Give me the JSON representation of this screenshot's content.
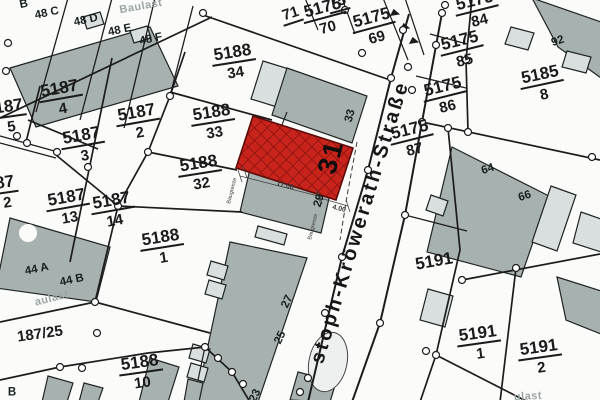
{
  "street": {
    "name": "stoph-Kröwerath-Straße"
  },
  "parcels": {
    "p5188_34": {
      "num": "5188",
      "den": "34"
    },
    "p5188_33": {
      "num": "5188",
      "den": "33"
    },
    "p5188_32": {
      "num": "5188",
      "den": "32"
    },
    "p5188_1": {
      "num": "5188",
      "den": "1"
    },
    "p5188_10": {
      "num": "5188",
      "den": "10"
    },
    "p5187_4": {
      "num": "5187",
      "den": "4"
    },
    "p5187_3": {
      "num": "5187",
      "den": "3"
    },
    "p5187_2": {
      "num": "5187",
      "den": "2"
    },
    "p5187_13": {
      "num": "5187",
      "den": "13"
    },
    "p5187_14": {
      "num": "5187",
      "den": "14"
    },
    "p187_5": {
      "num": "187",
      "den": "5"
    },
    "p87_2": {
      "num": "87",
      "den": "2"
    },
    "p5175_70": {
      "num": "5175",
      "den": "70"
    },
    "p5175_69": {
      "num": "5175",
      "den": "69"
    },
    "p5175_84": {
      "num": "5175",
      "den": "84"
    },
    "p5175_85": {
      "num": "5175",
      "den": "85"
    },
    "p5175_86": {
      "num": "5175",
      "den": "86"
    },
    "p5175_87": {
      "num": "5175",
      "den": "87"
    },
    "p5185_8": {
      "num": "5185",
      "den": "8"
    },
    "p5191_1": {
      "num": "5191",
      "den": "1"
    },
    "p5191_2": {
      "num": "5191",
      "den": "2"
    }
  },
  "singles": {
    "s71": "71",
    "s75": "75",
    "s5191": "5191",
    "s187_25": "187/25"
  },
  "houses": {
    "b_top": "B",
    "h48c": "48 C",
    "h48d": "48 D",
    "h48e": "48 E",
    "h48f": "48 F",
    "h44a": "44 A",
    "h44b": "44 B",
    "h92": "92",
    "h64": "64",
    "h66": "66",
    "h33": "33",
    "h29": "29",
    "h27": "27",
    "h25": "25",
    "h23": "23",
    "b_bottom": "B"
  },
  "highlight": {
    "number": "31"
  },
  "notes": {
    "baulast_top": "Baulast",
    "baulast_left": "aulast",
    "baulast_bottom": "ulast"
  },
  "dimensions": {
    "length": "17.00",
    "depth": "4.00",
    "grenze_left": "Baugrenze",
    "grenze_right": "Baugrenze"
  },
  "colors": {
    "building": "#a6b1b0",
    "building_light": "#d9dfde",
    "red_fill": "#c8241c",
    "red_hatch": "#7d100c",
    "line": "#1c1c1c",
    "gray_text": "#9aa5a3"
  }
}
